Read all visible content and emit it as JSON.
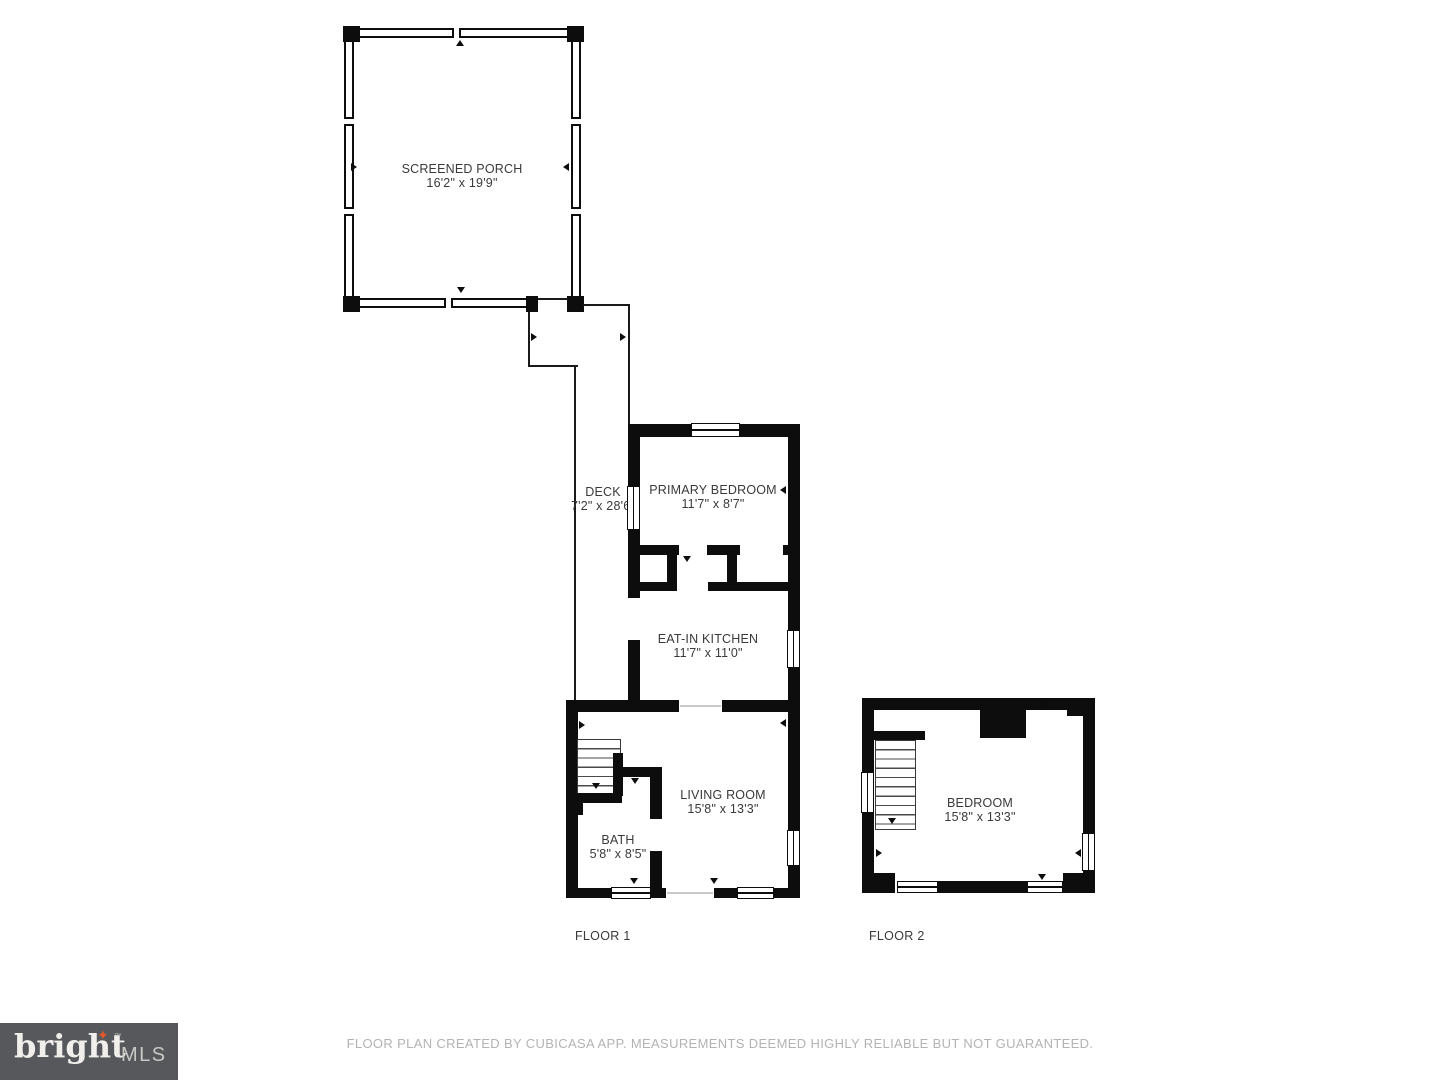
{
  "rooms": [
    {
      "id": "screened-porch",
      "name": "SCREENED PORCH",
      "dims": "16'2\" x 19'9\""
    },
    {
      "id": "deck",
      "name": "DECK",
      "dims": "7'2\" x 28'6\""
    },
    {
      "id": "primary-bedroom",
      "name": "PRIMARY BEDROOM",
      "dims": "11'7\" x 8'7\""
    },
    {
      "id": "eat-in-kitchen",
      "name": "EAT-IN KITCHEN",
      "dims": "11'7\" x 11'0\""
    },
    {
      "id": "living-room",
      "name": "LIVING ROOM",
      "dims": "15'8\" x 13'3\""
    },
    {
      "id": "bath",
      "name": "BATH",
      "dims": "5'8\" x 8'5\""
    },
    {
      "id": "bedroom",
      "name": "BEDROOM",
      "dims": "15'8\" x 13'3\""
    }
  ],
  "floors": [
    {
      "label": "FLOOR 1"
    },
    {
      "label": "FLOOR 2"
    }
  ],
  "footer": {
    "disclaimer": "FLOOR PLAN CREATED BY CUBICASA APP. MEASUREMENTS DEEMED HIGHLY RELIABLE BUT NOT GUARANTEED."
  },
  "logo": {
    "brand": "bright",
    "tm": "™",
    "suffix": "MLS",
    "star_glyph": "✦"
  },
  "colors": {
    "wall": "#0d0d0d",
    "label_text": "#3a3a3a",
    "disclaimer_text": "#b3b3b3",
    "logo_bg": "#57585b",
    "logo_accent": "#e0572b"
  }
}
